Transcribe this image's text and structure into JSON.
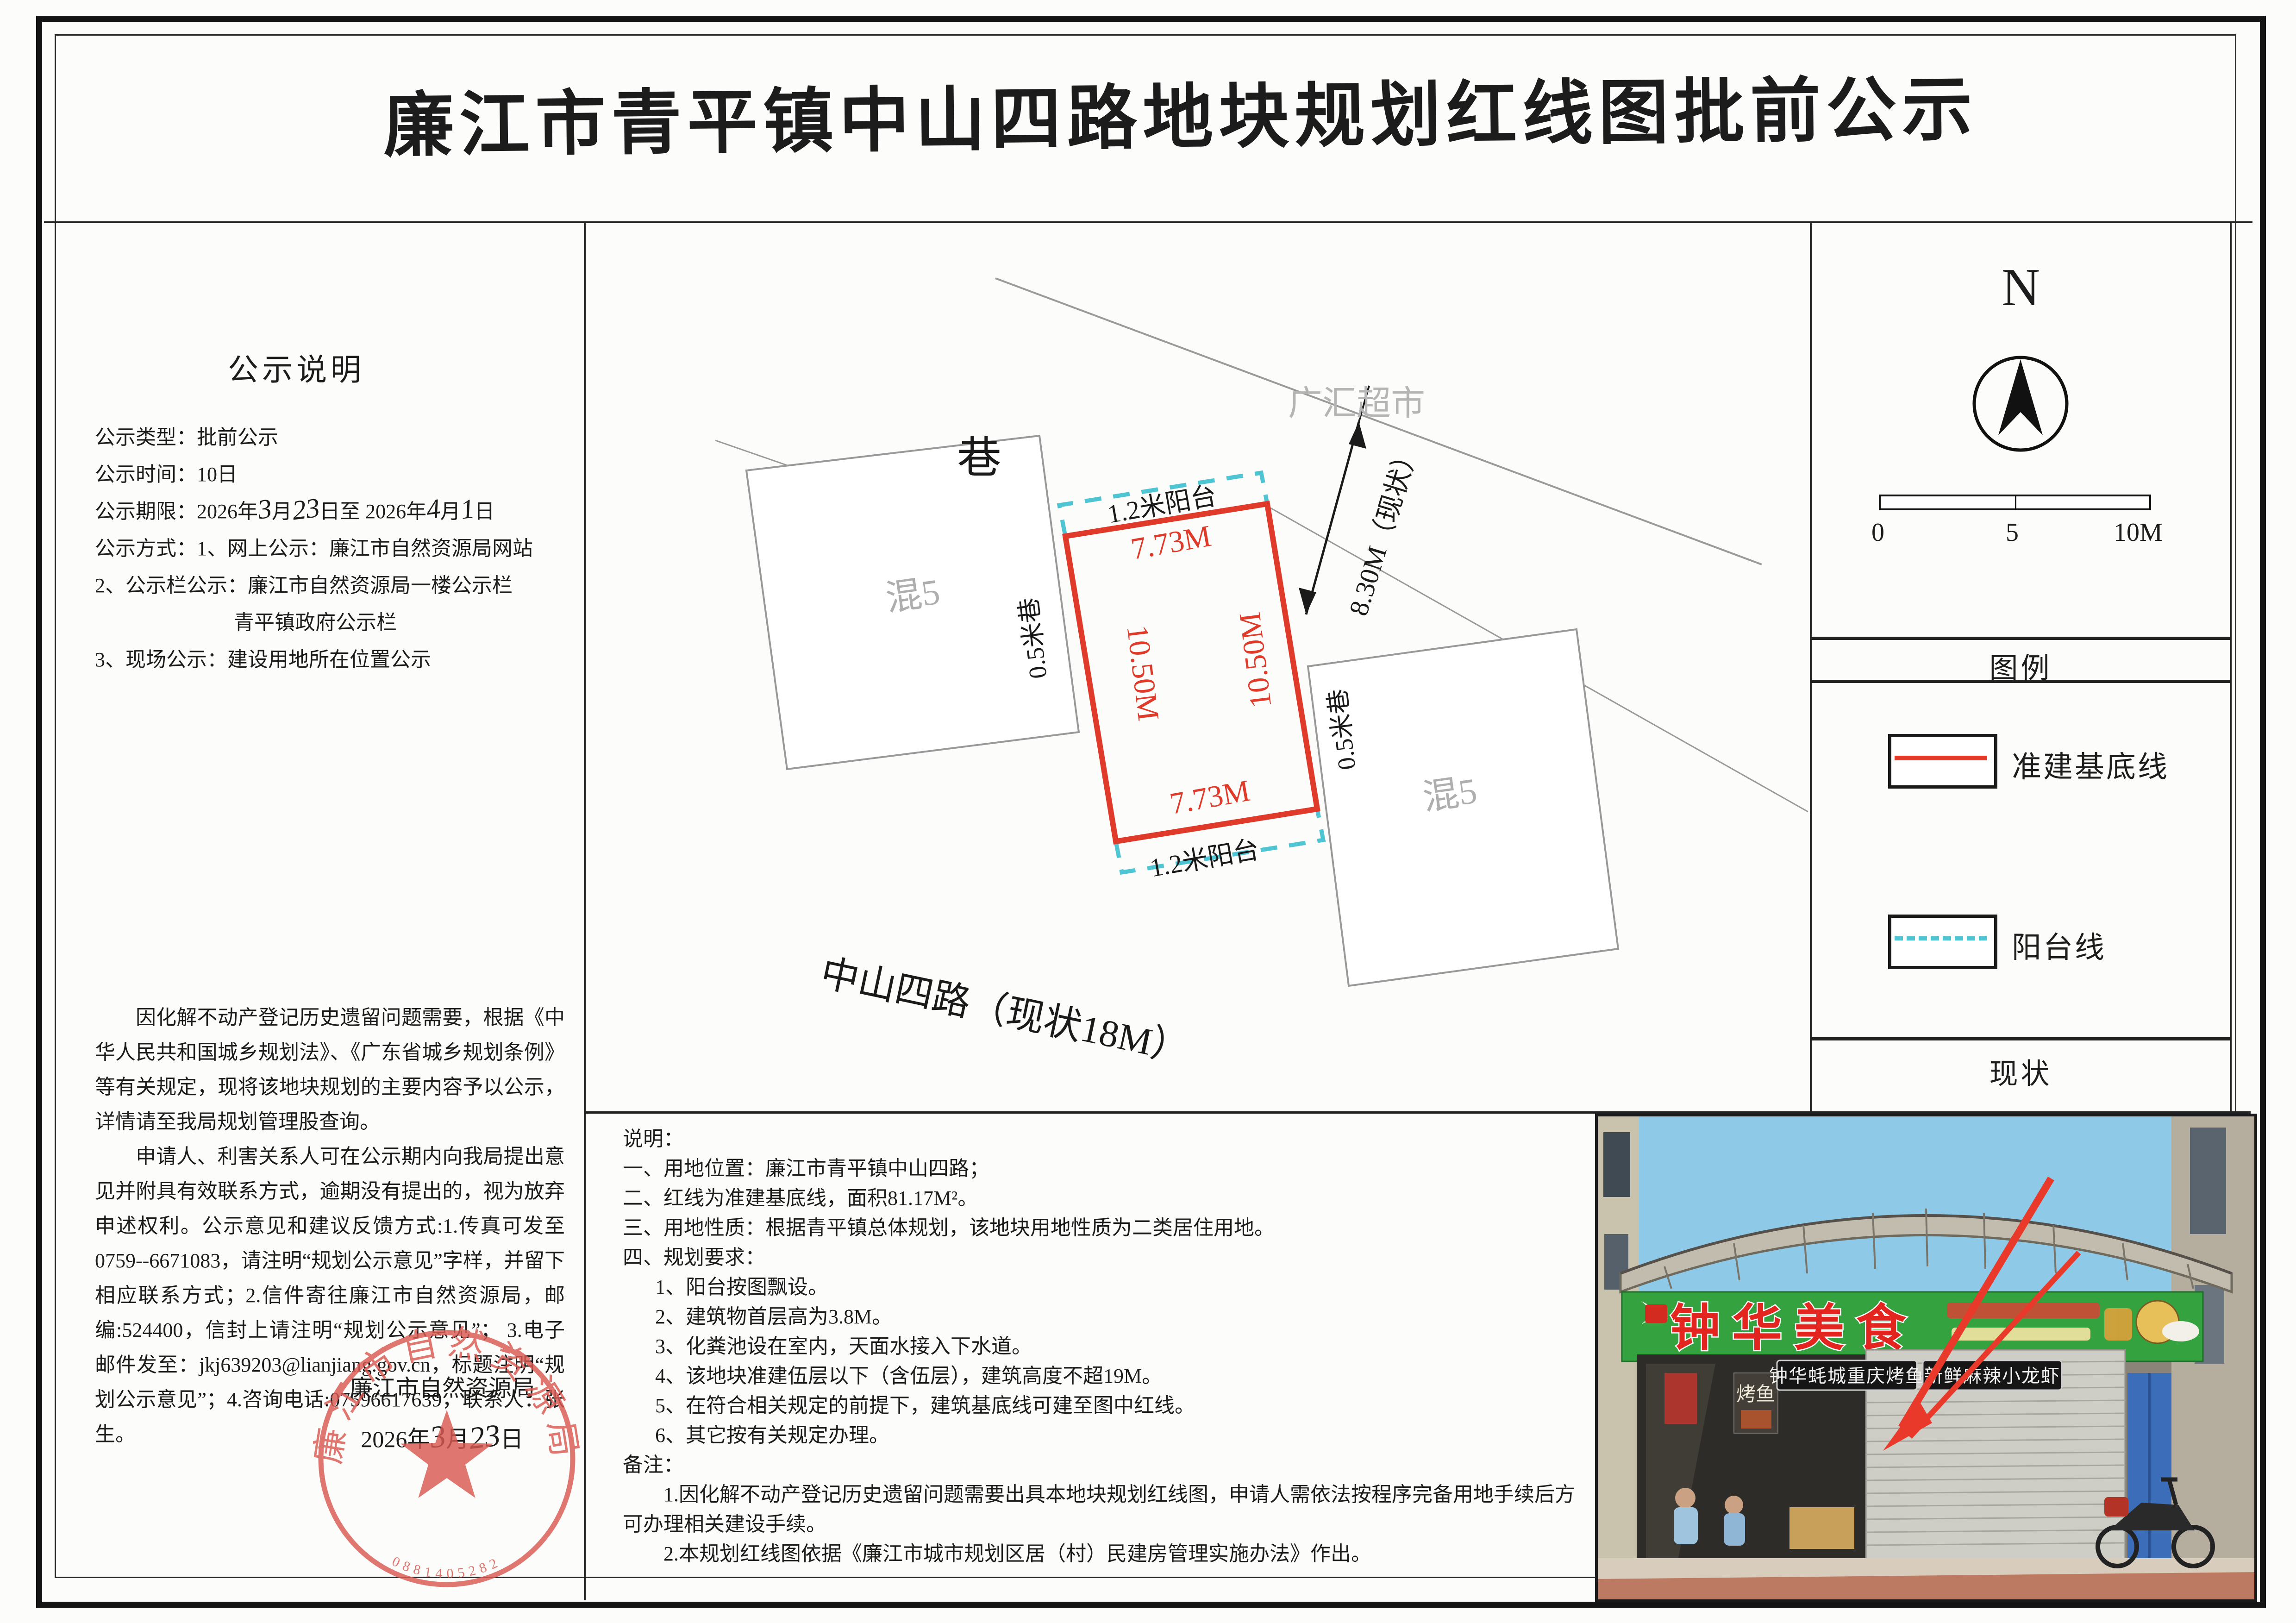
{
  "title": "廉江市青平镇中山四路地块规划红线图批前公示",
  "left_panel": {
    "heading": "公示说明",
    "line_type": "公示类型：批前公示",
    "line_duration": "公示时间：10日",
    "deadline": {
      "label": "公示期限：",
      "y1": "2026年",
      "m1": "3",
      "mu1": "月",
      "d1": "23",
      "du1": "日至",
      "y2": "2026年",
      "m2": "4",
      "mu2": "月",
      "d2": "1",
      "du2": "日"
    },
    "line_method": "公示方式：1、网上公示：廉江市自然资源局网站",
    "line_method2": "2、公示栏公示：廉江市自然资源局一楼公示栏",
    "line_method2b": "青平镇政府公示栏",
    "line_method3": "3、现场公示：建设用地所在位置公示",
    "paragraph1": "因化解不动产登记历史遗留问题需要，根据《中华人民共和国城乡规划法》、《广东省城乡规划条例》等有关规定，现将该地块规划的主要内容予以公示，详情请至我局规划管理股查询。",
    "paragraph2": "申请人、利害关系人可在公示期内向我局提出意见并附具有效联系方式，逾期没有提出的，视为放弃申述权利。公示意见和建议反馈方式:1.传真可发至0759--6671083，请注明“规划公示意见”字样，并留下相应联系方式；2.信件寄往廉江市自然资源局，邮编:524400，信封上请注明“规划公示意见”； 3.电子邮件发至：jkj639203@lianjiang.gov.cn，标题注明“规划公示意见”；4.咨询电话:07596617639，联系人：张生。",
    "sig_org": "廉江市自然资源局",
    "sig_date": {
      "y": "2026年",
      "m": "3",
      "mu": "月",
      "d": "23",
      "du": "日"
    }
  },
  "stamp": {
    "arc_text": "廉江市自然资源局",
    "serial": "0881405282"
  },
  "diagram": {
    "lane": "巷",
    "supermarket": "广汇超市",
    "dim_north": "8.30M（现状）",
    "balcony_top": "1.2米阳台",
    "balcony_bottom": "1.2米阳台",
    "width_top": "7.73M",
    "width_bottom": "7.73M",
    "depth_left": "10.50M",
    "depth_right": "10.50M",
    "lane_left": "0.5米巷",
    "lane_right": "0.5米巷",
    "parcel_left": "混5",
    "parcel_right": "混5",
    "road": "中山四路（现状18M）"
  },
  "right_panel": {
    "north": "N",
    "scale_ticks": [
      "0",
      "5",
      "10M"
    ],
    "legend_header": "图例",
    "legend_item1": "准建基底线",
    "legend_item2": "阳台线",
    "status_header": "现状"
  },
  "notes": {
    "lines": [
      "说明：",
      "一、用地位置：廉江市青平镇中山四路；",
      "二、红线为准建基底线，面积81.17M²。",
      "三、用地性质：根据青平镇总体规划，该地块用地性质为二类居住用地。",
      "四、规划要求：",
      "1、阳台按图飘设。",
      "2、建筑物首层高为3.8M。",
      "3、化粪池设在室内，天面水接入下水道。",
      "4、该地块准建伍层以下（含伍层），建筑高度不超19M。",
      "5、在符合相关规定的前提下，建筑基底线可建至图中红线。",
      "6、其它按有关规定办理。",
      "备注：",
      "1.因化解不动产登记历史遗留问题需要出具本地块规划红线图，申请人需依法按程序完备用地手续后方可办理相关建设手续。",
      "2.本规划红线图依据《廉江市城市规划区居（村）民建房管理实施办法》作出。"
    ]
  },
  "photo": {
    "sign_main": "钟华美食",
    "banner_left": "钟华蚝城重庆烤鱼",
    "banner_right": "新鲜麻辣小龙虾",
    "poster": "烤鱼"
  },
  "colors": {
    "red_line": "#e03a2a",
    "cyan_dashed": "#4fc4d3",
    "seal_red": "#d95a52",
    "sign_green": "#33a23f"
  }
}
